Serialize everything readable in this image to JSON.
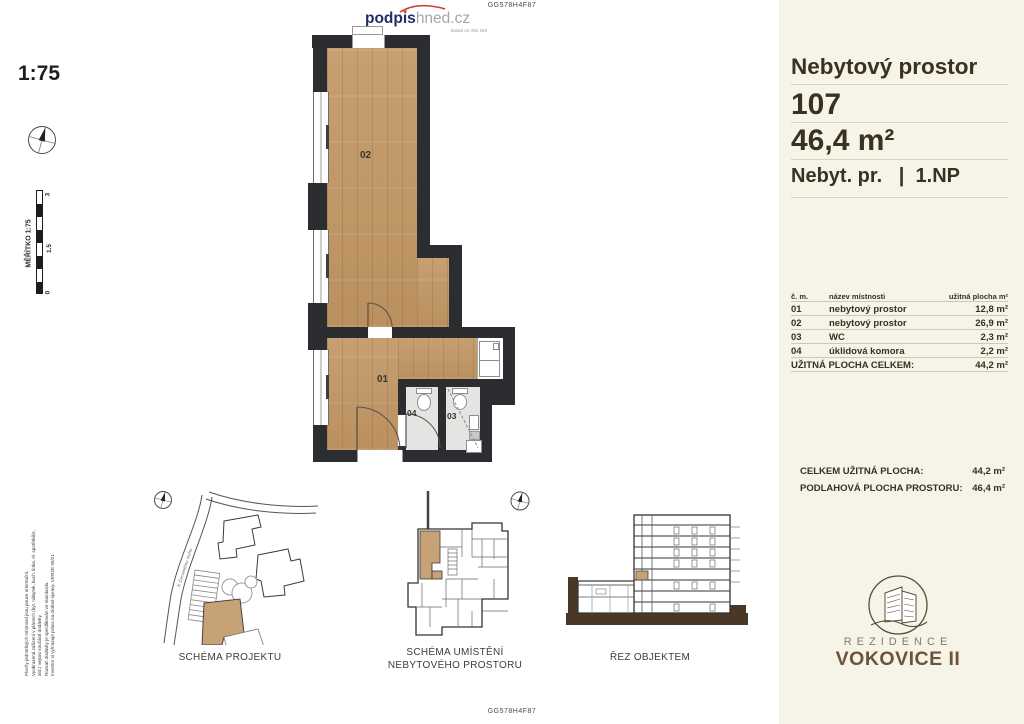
{
  "codes": {
    "top": "GG578H4F87",
    "bottom": "GG578H4F87"
  },
  "logo": {
    "bold": "podpis",
    "light": "hned.cz",
    "tagline": "based on ING OM"
  },
  "scale": {
    "ratio": "1:75",
    "bar_label": "MĚŘÍTKO  1:75",
    "ticks": {
      "max": "3",
      "mid": "1.5",
      "min": "0"
    }
  },
  "disclaimer": {
    "line1": "Plochy jednotlivých místností jsou pouze orientační.",
    "line2": "Vyobrazená zařízení v plánech (byt. nábytek, kuch. linka, el. spotřebiče,",
    "line3": "atd.) nejsou součástí dodávky.",
    "line4": "Rozsah dodávky je specifikován ve standardu.",
    "line5": "Investor si vyhrazuje právo na drobné úpravy. VERZE 05/21"
  },
  "plan": {
    "room_01": "01",
    "room_02": "02",
    "room_03": "03",
    "room_04": "04"
  },
  "panel": {
    "title": "Nebytový prostor",
    "unit_number": "107",
    "unit_area": "46,4 m²",
    "unit_type": "Nebyt. pr.   |  1.NP",
    "table": {
      "headers": {
        "col1": "č. m.",
        "col2": "název místnosti",
        "col3": "užitná plocha m²"
      },
      "rows": [
        {
          "num": "01",
          "name": "nebytový prostor",
          "area": "12,8 m²"
        },
        {
          "num": "02",
          "name": "nebytový prostor",
          "area": "26,9 m²"
        },
        {
          "num": "03",
          "name": "WC",
          "area": "2,3 m²"
        },
        {
          "num": "04",
          "name": "úklidová komora",
          "area": "2,2 m²"
        }
      ],
      "total_label": "UŽITNÁ PLOCHA CELKEM:",
      "total_value": "44,2 m²"
    },
    "summary": {
      "row1_label": "CELKEM UŽITNÁ PLOCHA:",
      "row1_value": "44,2 m²",
      "row2_label": "PODLAHOVÁ PLOCHA PROSTORU:",
      "row2_value": "46,4 m²"
    },
    "brand": {
      "line1": "REZIDENCE",
      "line2": "VOKOVICE II"
    }
  },
  "diagrams": {
    "site_caption": "SCHÉMA PROJEKTU",
    "location_caption_line1": "SCHÉMA UMÍSTĚNÍ",
    "location_caption_line2": "NEBYTOVÉHO PROSTORU",
    "section_caption": "ŘEZ OBJEKTEM",
    "street_label": "K Červenému vrchu"
  },
  "colors": {
    "panel_bg": "#f6f4e7",
    "wall": "#2b2d31",
    "wood": "#c49c6d",
    "highlight": "#c8a277",
    "text_dark": "#3a3123"
  }
}
